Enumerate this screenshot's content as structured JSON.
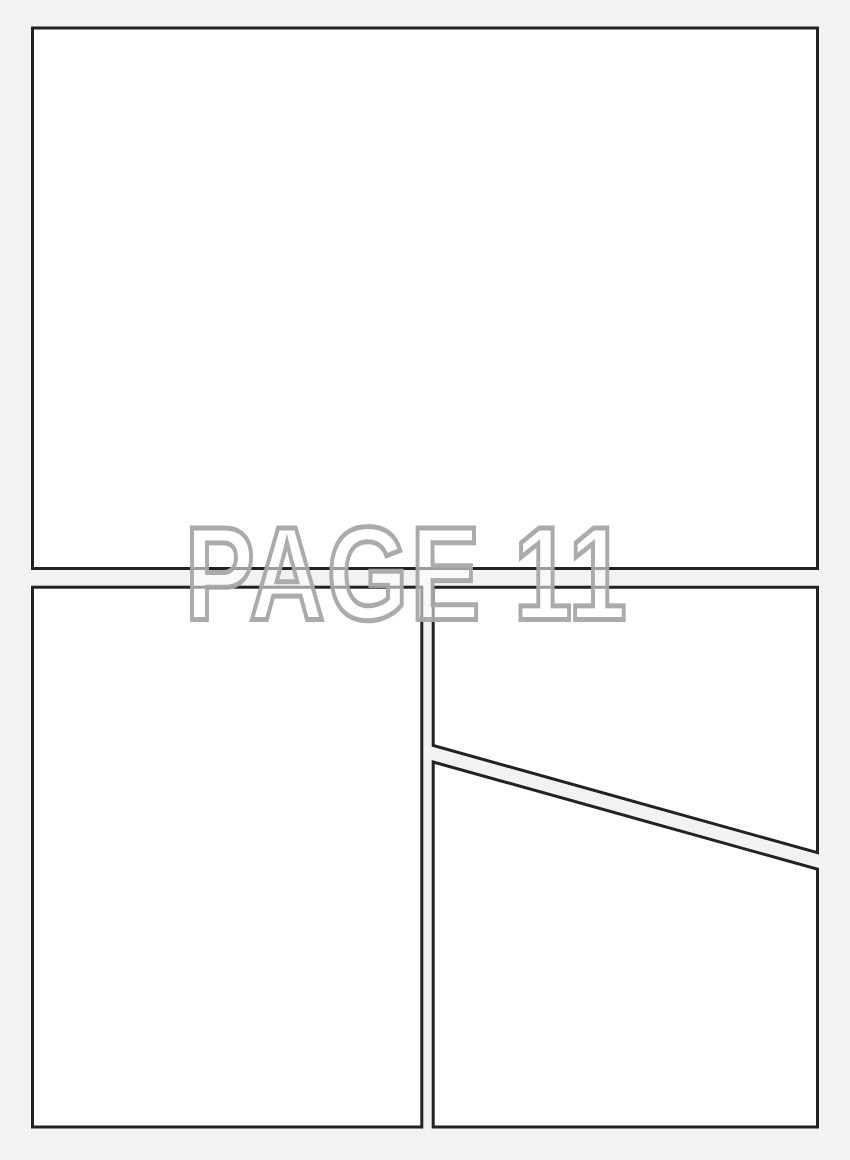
{
  "page_label": {
    "text": "PAGE 11"
  },
  "panels": [
    {
      "id": "top",
      "shape": "rectangle",
      "content": ""
    },
    {
      "id": "bottom-left",
      "shape": "rectangle",
      "content": ""
    },
    {
      "id": "upper-right",
      "shape": "polygon-diagonal-bottom",
      "content": ""
    },
    {
      "id": "lower-right",
      "shape": "polygon-diagonal-top",
      "content": ""
    }
  ],
  "colors": {
    "canvas_background": "#f2f2f2",
    "panel_fill": "#ffffff",
    "panel_border": "#222222",
    "label_outline": "#a6a6a6",
    "label_fill": "#ffffff"
  }
}
